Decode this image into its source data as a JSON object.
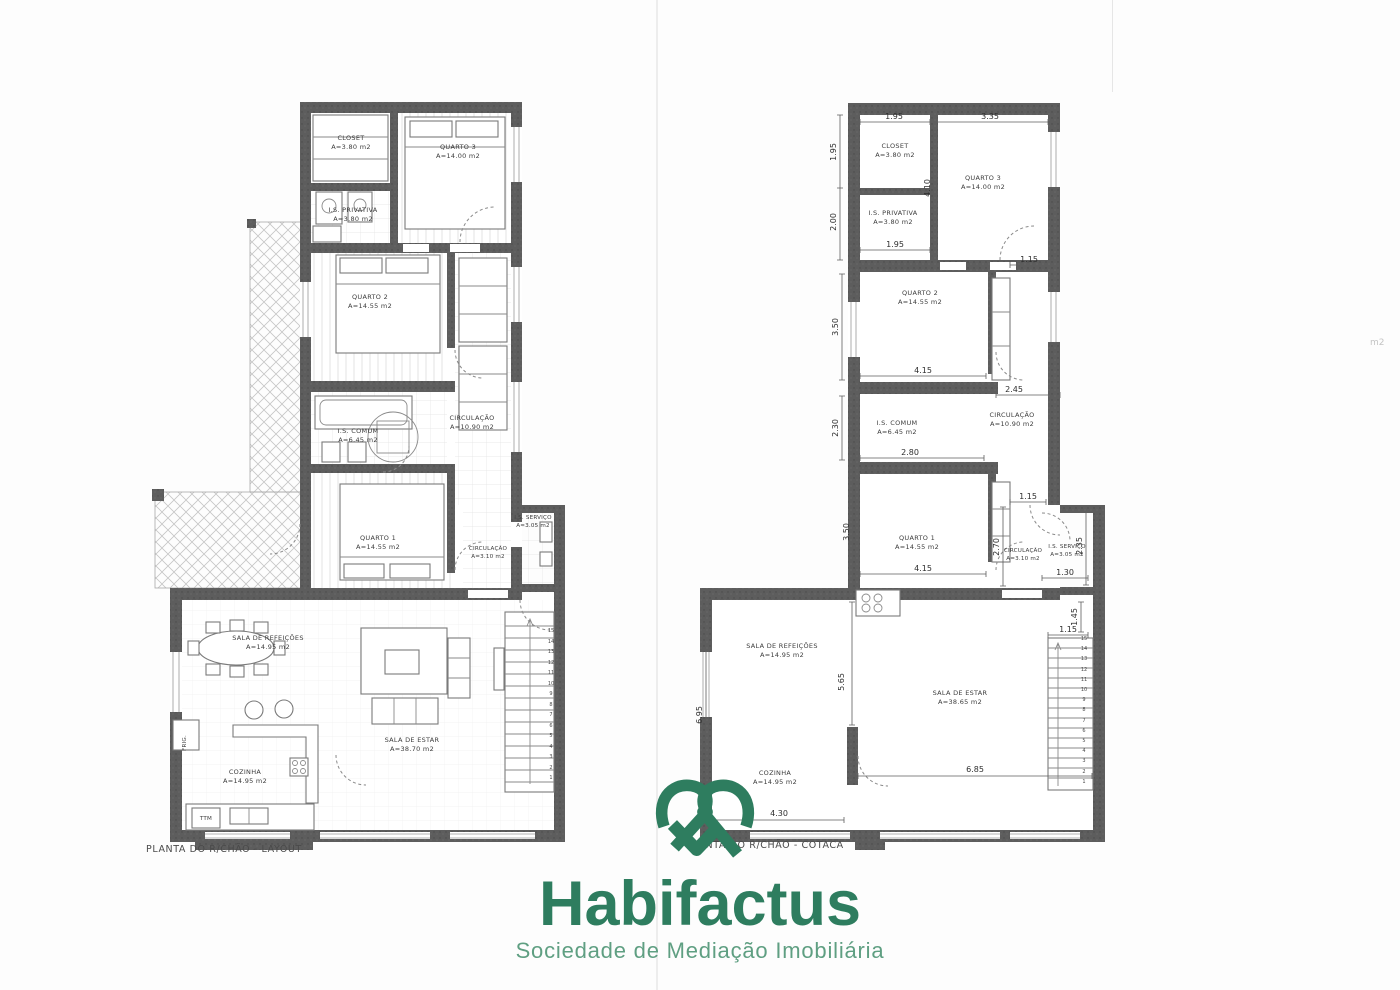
{
  "page": {
    "width": 1400,
    "height": 990,
    "background": "#fdfdfd",
    "artifacts": {
      "edge_note": "m2"
    }
  },
  "brand": {
    "name": "Habifactus",
    "tagline": "Sociedade de Mediação Imobiliária",
    "icon": "heart-ribbon-icon",
    "color_primary": "#2E7D5F",
    "color_tagline": "#5F9F82"
  },
  "palette": {
    "wall_gray": "#5d5d5d",
    "line_gray": "#8a8a8a",
    "label_gray": "#3c3c3c"
  },
  "plans": {
    "left": {
      "caption": "PLANTA DO R/CHÃO - LAYOUT",
      "rooms": [
        {
          "name": "CLOSET",
          "area": "A=3.80 m2"
        },
        {
          "name": "QUARTO 3",
          "area": "A=14.00 m2"
        },
        {
          "name": "I.S. PRIVATIVA",
          "area": "A=3.80 m2"
        },
        {
          "name": "QUARTO 2",
          "area": "A=14.55 m2"
        },
        {
          "name": "I.S. COMUM",
          "area": "A=6.45 m2"
        },
        {
          "name": "CIRCULAÇÃO",
          "area": "A=10.90 m2"
        },
        {
          "name": "QUARTO 1",
          "area": "A=14.55 m2"
        },
        {
          "name": "CIRCULAÇÃO",
          "area": "A=3.10 m2"
        },
        {
          "name": "I.S. SERVIÇO",
          "area": "A=3.05 m2"
        },
        {
          "name": "SALA DE REFEIÇÕES",
          "area": "A=14.95 m2"
        },
        {
          "name": "COZINHA",
          "area": "A=14.95 m2"
        },
        {
          "name": "SALA DE ESTAR",
          "area": "A=38.70 m2"
        }
      ],
      "appliances": {
        "fridge": "FRIG.",
        "washer": "TTM"
      },
      "stair_numbers": [
        "15",
        "14",
        "13",
        "12",
        "11",
        "10",
        "9",
        "8",
        "7",
        "6",
        "5",
        "4",
        "3",
        "2",
        "1"
      ]
    },
    "right": {
      "caption": "PLANTA DO R/CHÃO - COTACA",
      "rooms": [
        {
          "name": "CLOSET",
          "area": "A=3.80 m2"
        },
        {
          "name": "QUARTO 3",
          "area": "A=14.00 m2"
        },
        {
          "name": "I.S. PRIVATIVA",
          "area": "A=3.80 m2"
        },
        {
          "name": "QUARTO 2",
          "area": "A=14.55 m2"
        },
        {
          "name": "I.S. COMUM",
          "area": "A=6.45 m2"
        },
        {
          "name": "CIRCULAÇÃO",
          "area": "A=10.90 m2"
        },
        {
          "name": "QUARTO 1",
          "area": "A=14.55 m2"
        },
        {
          "name": "CIRCULAÇÃO",
          "area": "A=3.10 m2"
        },
        {
          "name": "I.S. SERVIÇO",
          "area": "A=3.05 m2"
        },
        {
          "name": "SALA DE REFEIÇÕES",
          "area": "A=14.95 m2"
        },
        {
          "name": "COZINHA",
          "area": "A=14.95 m2"
        },
        {
          "name": "SALA DE ESTAR",
          "area": "A=38.65 m2"
        }
      ],
      "dimensions": {
        "top_closet_w": "1.95",
        "top_q3_w": "3.35",
        "closet_h": "1.95",
        "priv_h": "2.00",
        "closet_depth": "4.10",
        "priv_w": "1.95",
        "q3_door": "1.15",
        "q2_h": "3.50",
        "q2_w": "4.15",
        "circ_w": "2.45",
        "is_comum_h": "2.30",
        "is_comum_w": "2.80",
        "q1_h": "3.50",
        "q1_w": "4.15",
        "hall_w": "1.15",
        "circ_h": "2.70",
        "is_servico_w": "1.30",
        "is_servico_h": "2.35",
        "stairs_off_h": "1.45",
        "stairs_w": "1.15",
        "living_h": "6.95",
        "kitchen_split_h": "5.65",
        "estar_w": "6.85",
        "cozinha_w": "4.30"
      },
      "stair_numbers": [
        "15",
        "14",
        "13",
        "12",
        "11",
        "10",
        "9",
        "8",
        "7",
        "6",
        "5",
        "4",
        "3",
        "2",
        "1"
      ]
    }
  }
}
